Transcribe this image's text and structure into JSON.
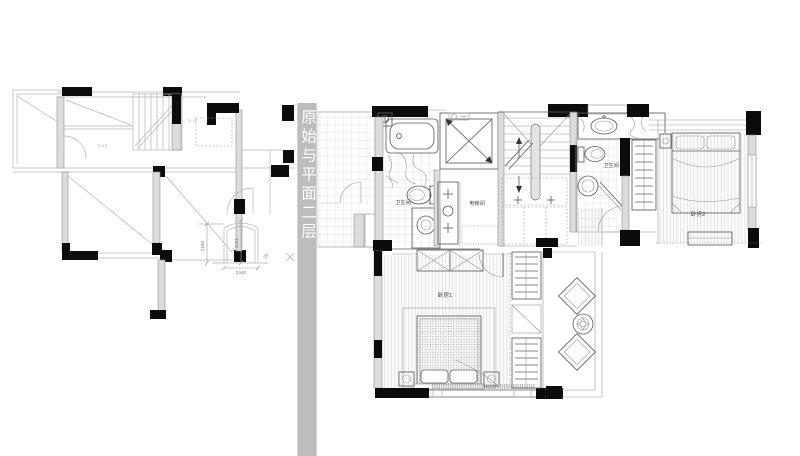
{
  "banner": {
    "text": "原始与平面二层",
    "background": "#bdbdbd",
    "text_color": "#ffffff"
  },
  "plans": {
    "left": {
      "annotations": [
        {
          "label": "TL 10"
        },
        {
          "label": "TL 1F"
        }
      ],
      "dimensions": [
        {
          "value": "2160"
        },
        {
          "value": "2251"
        },
        {
          "value": "2440"
        },
        {
          "value": "25"
        }
      ]
    },
    "right": {
      "rooms": [
        {
          "id": "bathroom-1",
          "label": "卫生间"
        },
        {
          "id": "elevator-room",
          "label": "电梯间"
        },
        {
          "id": "bathroom-2",
          "label": "卫生间"
        },
        {
          "id": "bedroom-1",
          "label": "卧房1"
        },
        {
          "id": "bedroom-2",
          "label": "卧房2"
        }
      ]
    }
  },
  "colors": {
    "wall_black": "#0c0c0c",
    "wall_gray": "#dcdcdc",
    "line_dark": "#5f5f5f",
    "line_light": "#b5b5b5",
    "banner_gray": "#bdbdbd"
  }
}
